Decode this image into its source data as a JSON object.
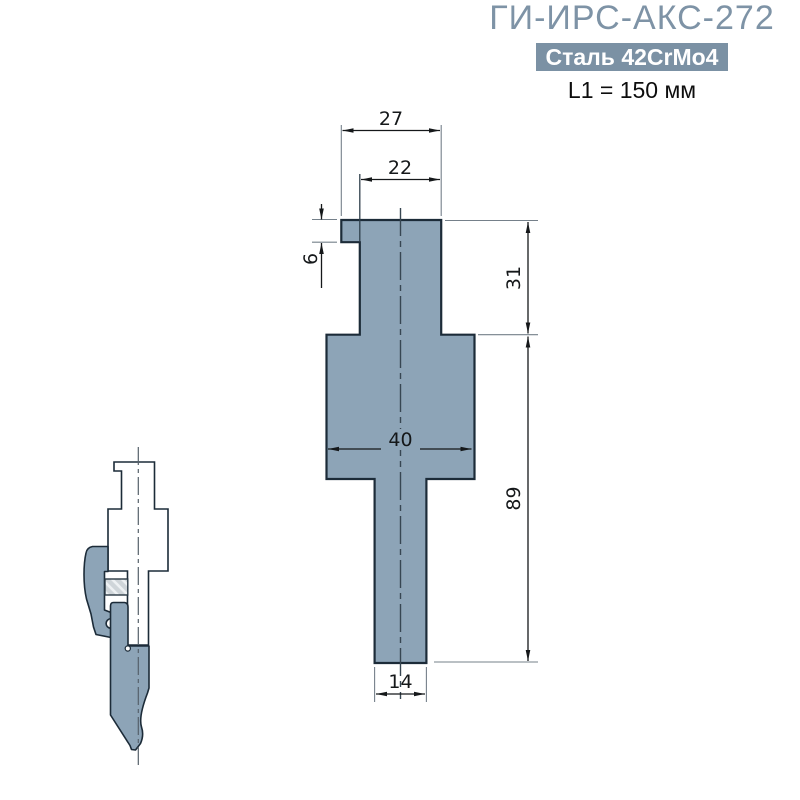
{
  "header": {
    "title": "ГИ-ИРС-АКС-272",
    "material_badge": "Сталь 42CrMo4",
    "length_note": "L1 = 150 мм"
  },
  "drawing": {
    "type": "technical-cross-section",
    "dimensions_mm": {
      "head_top_width": "27",
      "head_width": "22",
      "head_step_height": "6",
      "upper_height": "31",
      "lower_height": "89",
      "body_width": "40",
      "stem_width": "14"
    },
    "colors": {
      "part_fill": "#8DA4B7",
      "part_outline": "#1C2B38",
      "badge_bg": "#7B91A4",
      "title_color": "#7E93A6",
      "screw_fill": "#CFD5D9"
    }
  }
}
